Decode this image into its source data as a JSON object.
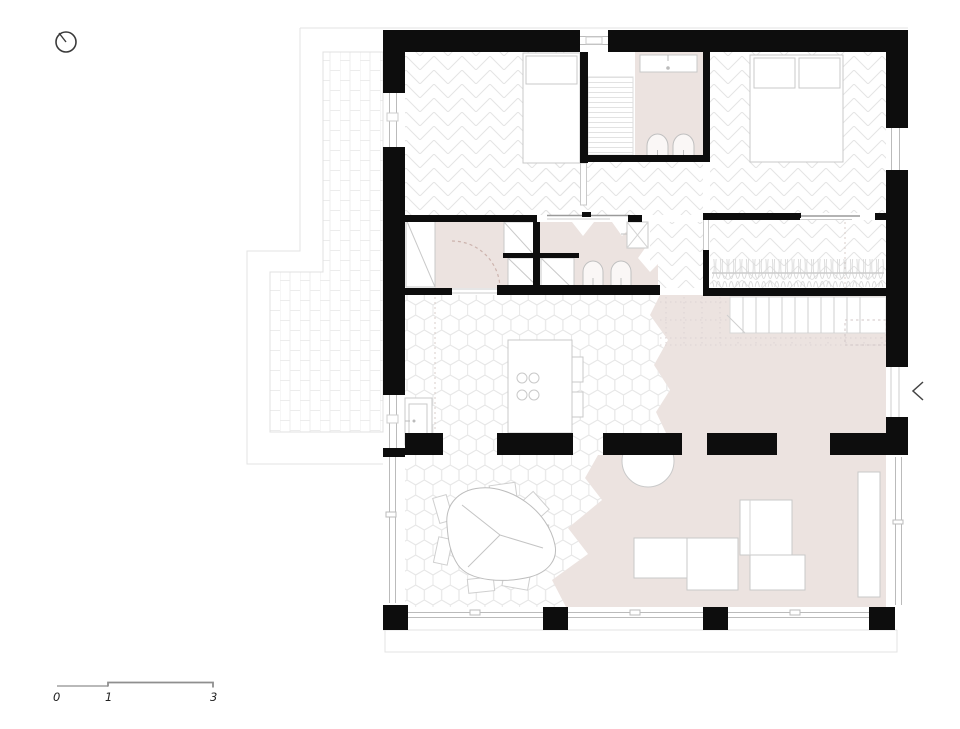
{
  "meta": {
    "drawing_type": "architectural floor plan, single storey house with terraces",
    "orientation_icon": "north-arrow"
  },
  "scalebar": {
    "labels": [
      "0",
      "1",
      "3"
    ],
    "unit": "meters (implied)"
  },
  "icons": {
    "north_arrow": "circle with needle tick",
    "entrance_chevron": "<"
  },
  "colors": {
    "wall_black": "#0d0d0d",
    "accent_floor_pink": "#ece3e0",
    "pattern_line": "#e4e4e4",
    "hex_line": "#e9e9e9",
    "brick_line": "#ececec",
    "furniture_stroke": "#c9c9c9",
    "fixture_stroke": "#c0c0c0",
    "glazing_line": "#bbbbbb",
    "dash_pink": "#ccb3ad",
    "annotation": "#3a3a3a"
  },
  "rooms_depicted": {
    "note": "no text labels are rendered on the plan",
    "list": [
      "bedroom-1",
      "bathroom-1",
      "master-bedroom",
      "hall-corridor",
      "bathroom-2",
      "walk-in-closet",
      "stairs",
      "kitchen",
      "dining-area",
      "living-room",
      "terrace-west",
      "terrace-south"
    ]
  }
}
